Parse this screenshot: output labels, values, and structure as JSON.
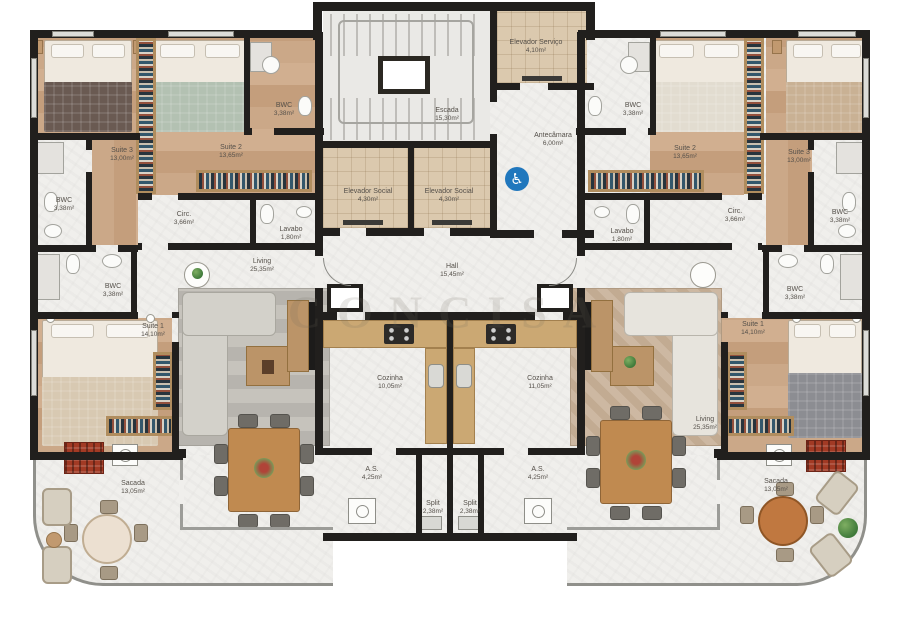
{
  "watermark": "CONCISA",
  "palette": {
    "wall": "#211f1d",
    "wood_floor": "#c9a486",
    "marble_floor": "#f0efec",
    "elevator_floor": "#dbc9ae",
    "accent_wood": "#c08a50",
    "grill_red": "#a23a24",
    "accessibility_blue": "#2077bd"
  },
  "core": {
    "elevador_servico": {
      "name": "Elevador Serviço",
      "area": "4,10m²"
    },
    "escada": {
      "name": "Escada",
      "area": "15,30m²"
    },
    "antecamara": {
      "name": "Antecâmara",
      "area": "6,00m²"
    },
    "elevador_social_1": {
      "name": "Elevador Social",
      "area": "4,30m²"
    },
    "elevador_social_2": {
      "name": "Elevador Social",
      "area": "4,30m²"
    },
    "hall": {
      "name": "Hall",
      "area": "15,45m²"
    },
    "accessibility": {
      "icon": "wheelchair-icon",
      "glyph": "♿"
    }
  },
  "unit_left": {
    "suite_3": {
      "name": "Suite 3",
      "area": "13,00m²"
    },
    "suite_2": {
      "name": "Suite 2",
      "area": "13,65m²"
    },
    "suite_1": {
      "name": "Suite 1",
      "area": "14,10m²"
    },
    "bwc_suite_2": {
      "name": "BWC",
      "area": "3,38m²"
    },
    "bwc_suite_3": {
      "name": "BWC",
      "area": "3,38m²"
    },
    "bwc_suite_1": {
      "name": "BWC",
      "area": "3,38m²"
    },
    "circ": {
      "name": "Circ.",
      "area": "3,66m²"
    },
    "lavabo": {
      "name": "Lavabo",
      "area": "1,80m²"
    },
    "living": {
      "name": "Living",
      "area": "25,35m²"
    },
    "cozinha": {
      "name": "Cozinha",
      "area": "10,05m²"
    },
    "area_servico": {
      "name": "A.S.",
      "area": "4,25m²"
    },
    "split": {
      "name": "Split",
      "area": "2,38m²"
    },
    "sacada": {
      "name": "Sacada",
      "area": "13,05m²"
    }
  },
  "unit_right": {
    "suite_3": {
      "name": "Suite 3",
      "area": "13,00m²"
    },
    "suite_2": {
      "name": "Suite 2",
      "area": "13,65m²"
    },
    "suite_1": {
      "name": "Suite 1",
      "area": "14,10m²"
    },
    "bwc_suite_2": {
      "name": "BWC",
      "area": "3,38m²"
    },
    "bwc_suite_3": {
      "name": "BWC",
      "area": "3,38m²"
    },
    "bwc_suite_1": {
      "name": "BWC",
      "area": "3,38m²"
    },
    "circ": {
      "name": "Circ.",
      "area": "3,66m²"
    },
    "lavabo": {
      "name": "Lavabo",
      "area": "1,80m²"
    },
    "living": {
      "name": "Living",
      "area": "25,35m²"
    },
    "cozinha": {
      "name": "Cozinha",
      "area": "11,05m²"
    },
    "area_servico": {
      "name": "A.S.",
      "area": "4,25m²"
    },
    "split": {
      "name": "Split",
      "area": "2,38m²"
    },
    "sacada": {
      "name": "Sacada",
      "area": "13,05m²"
    }
  }
}
